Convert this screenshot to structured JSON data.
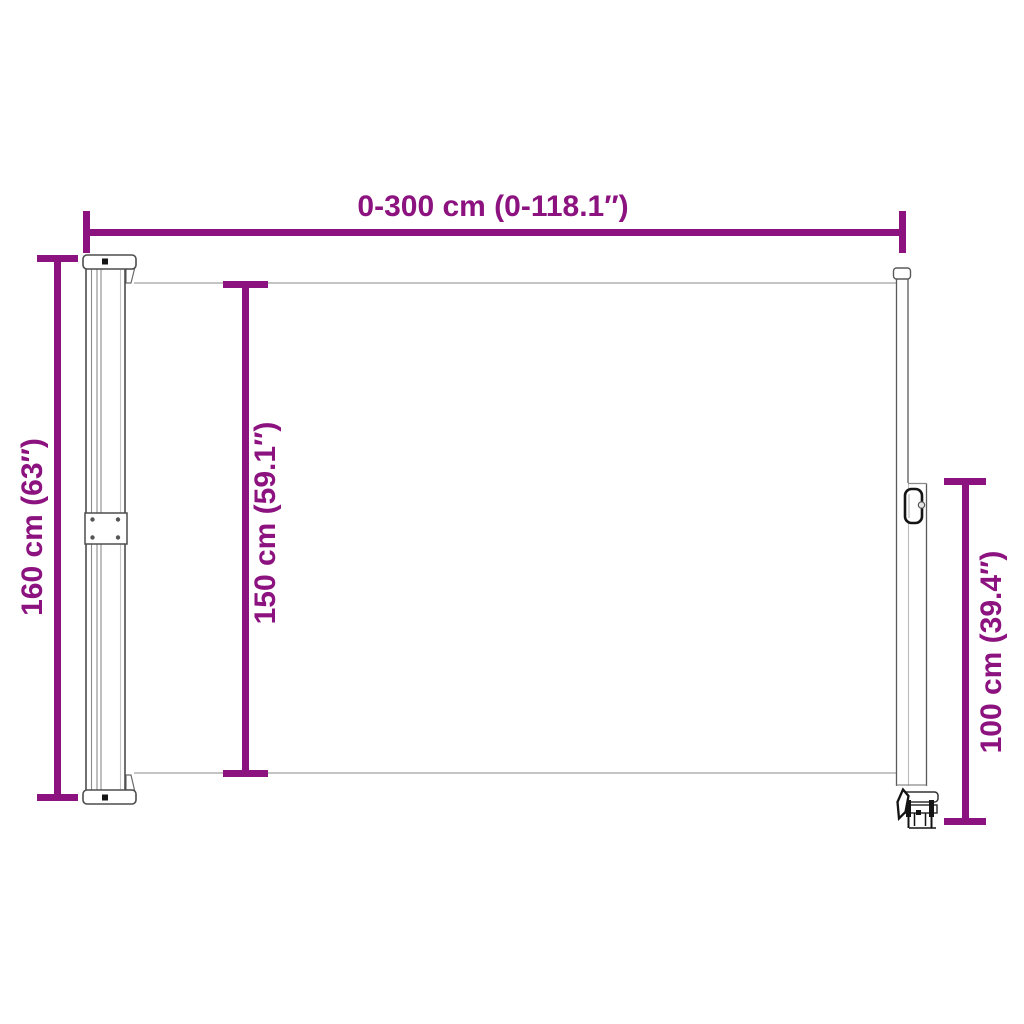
{
  "page": {
    "background": "#ffffff",
    "accent_color": "#8C137F",
    "line_color": "#4d4d4d",
    "fabric_edge_color": "#b0b0b0"
  },
  "dimensions": {
    "width": {
      "label": "0-300 cm (0-118.1″)",
      "orientation": "horizontal"
    },
    "height_total": {
      "label": "160 cm (63″)",
      "orientation": "vertical"
    },
    "height_fabric": {
      "label": "150 cm (59.1″)",
      "orientation": "vertical"
    },
    "height_pole": {
      "label": "100 cm (39.4″)",
      "orientation": "vertical"
    }
  }
}
